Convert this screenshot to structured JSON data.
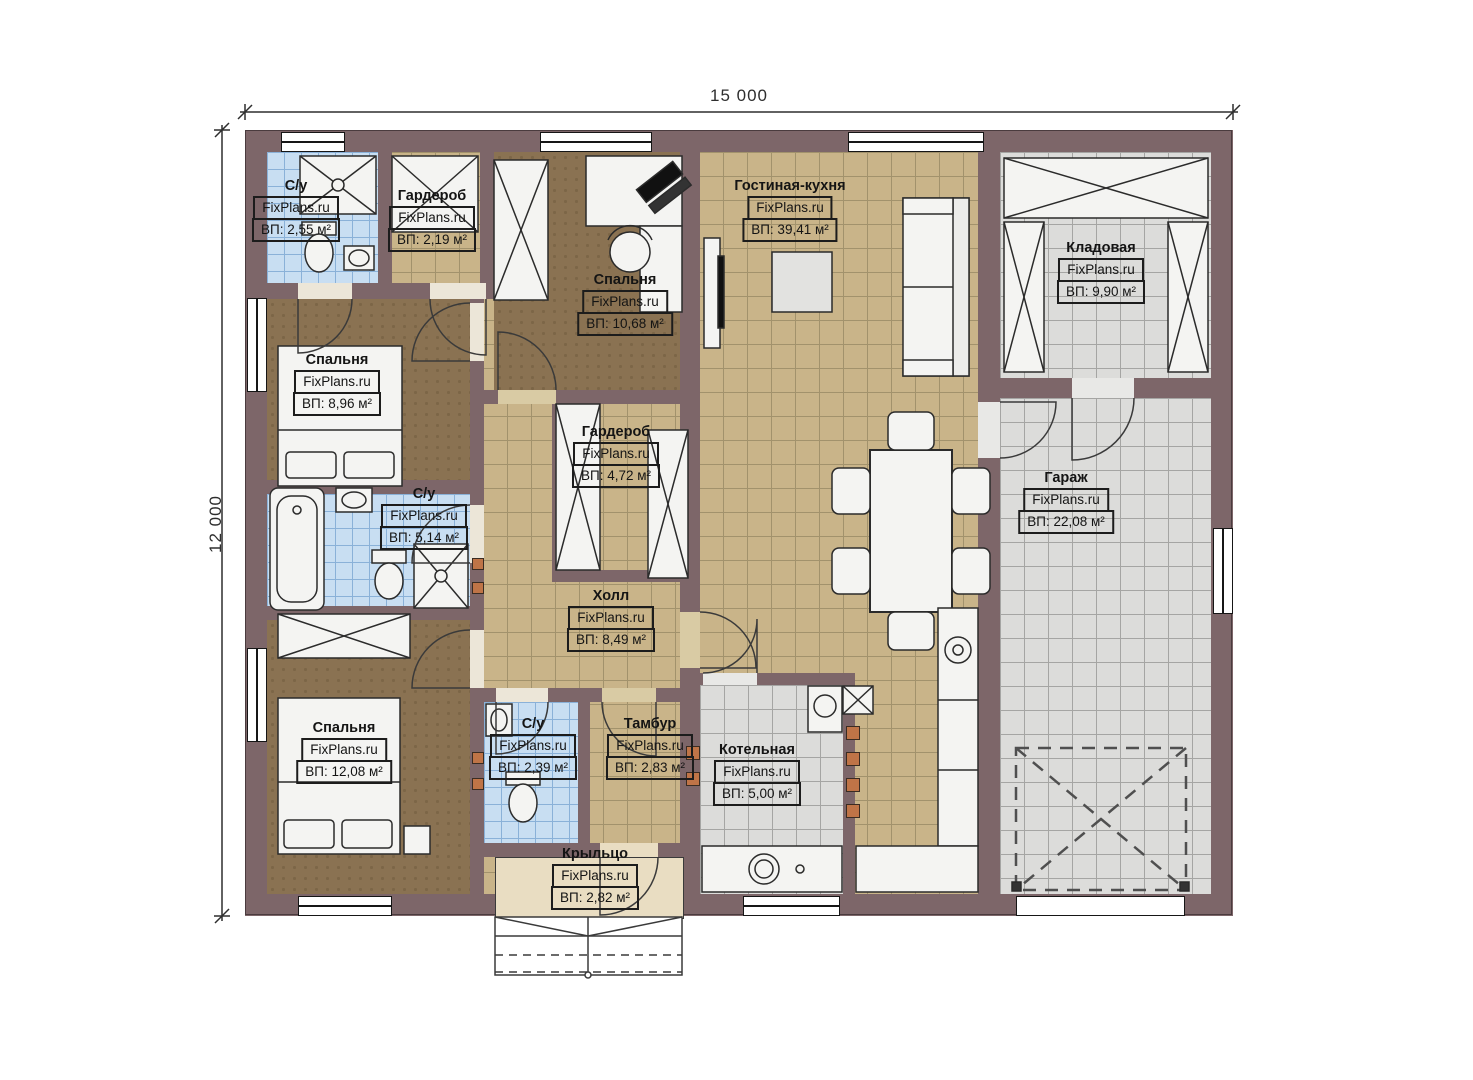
{
  "watermark": "FixPlans.ru",
  "dimensions": {
    "width_label": "15 000",
    "height_label": "12 000"
  },
  "rooms": [
    {
      "name": "С/у",
      "area": "ВП: 2,55 м²"
    },
    {
      "name": "Гардероб",
      "area": "ВП: 2,19 м²"
    },
    {
      "name": "Спальня",
      "area": "ВП: 10,68 м²"
    },
    {
      "name": "Гостиная-кухня",
      "area": "ВП: 39,41 м²"
    },
    {
      "name": "Кладовая",
      "area": "ВП: 9,90 м²"
    },
    {
      "name": "Спальня",
      "area": "ВП: 8,96 м²"
    },
    {
      "name": "С/у",
      "area": "ВП: 5,14 м²"
    },
    {
      "name": "Гардероб",
      "area": "ВП: 4,72 м²"
    },
    {
      "name": "Гараж",
      "area": "ВП: 22,08 м²"
    },
    {
      "name": "Холл",
      "area": "ВП: 8,49 м²"
    },
    {
      "name": "Спальня",
      "area": "ВП: 12,08 м²"
    },
    {
      "name": "С/у",
      "area": "ВП: 2,39 м²"
    },
    {
      "name": "Тамбур",
      "area": "ВП: 2,83 м²"
    },
    {
      "name": "Котельная",
      "area": "ВП: 5,00 м²"
    },
    {
      "name": "Крыльцо",
      "area": "ВП: 2,82 м²"
    }
  ],
  "colors": {
    "wall": "#7d6669",
    "floor_tile_tan": "#c9b489",
    "floor_tile_gray": "#dcdcda",
    "floor_tile_blue": "#c8def2",
    "floor_wood_brown": "#8a7252",
    "porch": "#e9ddc2",
    "accent_orange": "#bf7447"
  }
}
